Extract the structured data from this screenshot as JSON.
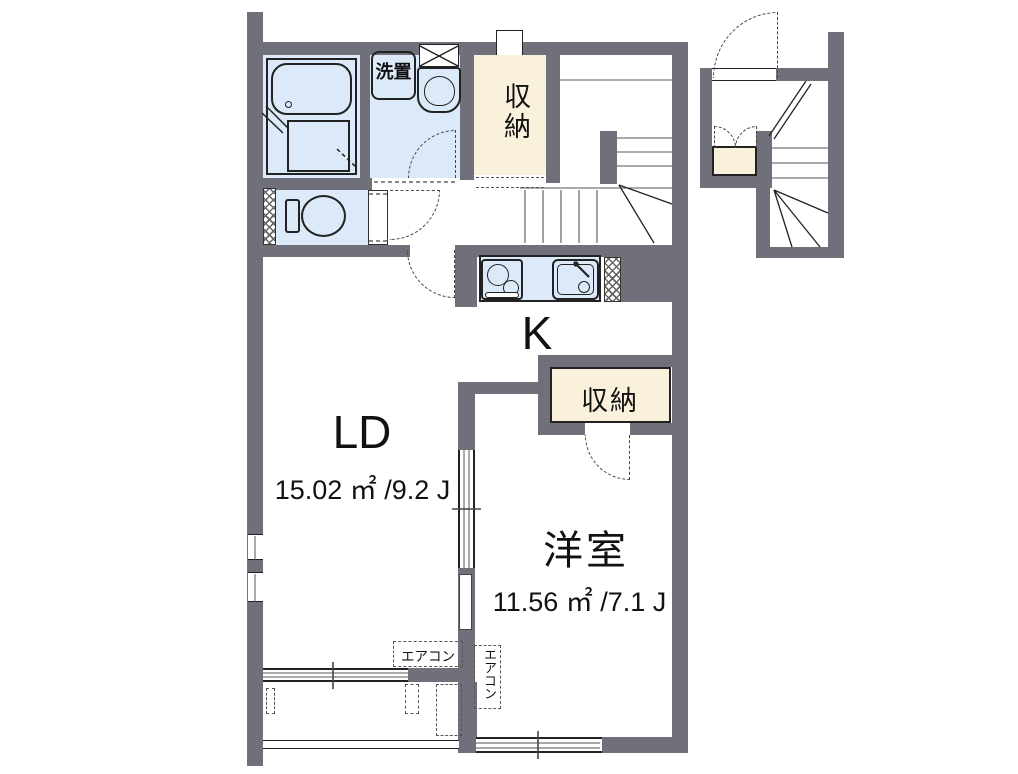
{
  "floorplan": {
    "rooms": {
      "living_dining": {
        "label": "LD",
        "area": "15.02 ㎡ /9.2 J"
      },
      "kitchen": {
        "label": "K"
      },
      "western_room": {
        "label": "洋室",
        "area": "11.56 ㎡ /7.1 J"
      },
      "storage_upper": {
        "label": "収納"
      },
      "storage_west": {
        "label": "収納"
      },
      "laundry": {
        "label": "洗置"
      }
    },
    "annotations": {
      "aircon_ld": "エアコン",
      "aircon_west": "エアコン"
    },
    "colors": {
      "wall": "#70707a",
      "wet_area": "#dce9f8",
      "storage": "#faf1dc",
      "line": "#1f1f1f"
    }
  }
}
